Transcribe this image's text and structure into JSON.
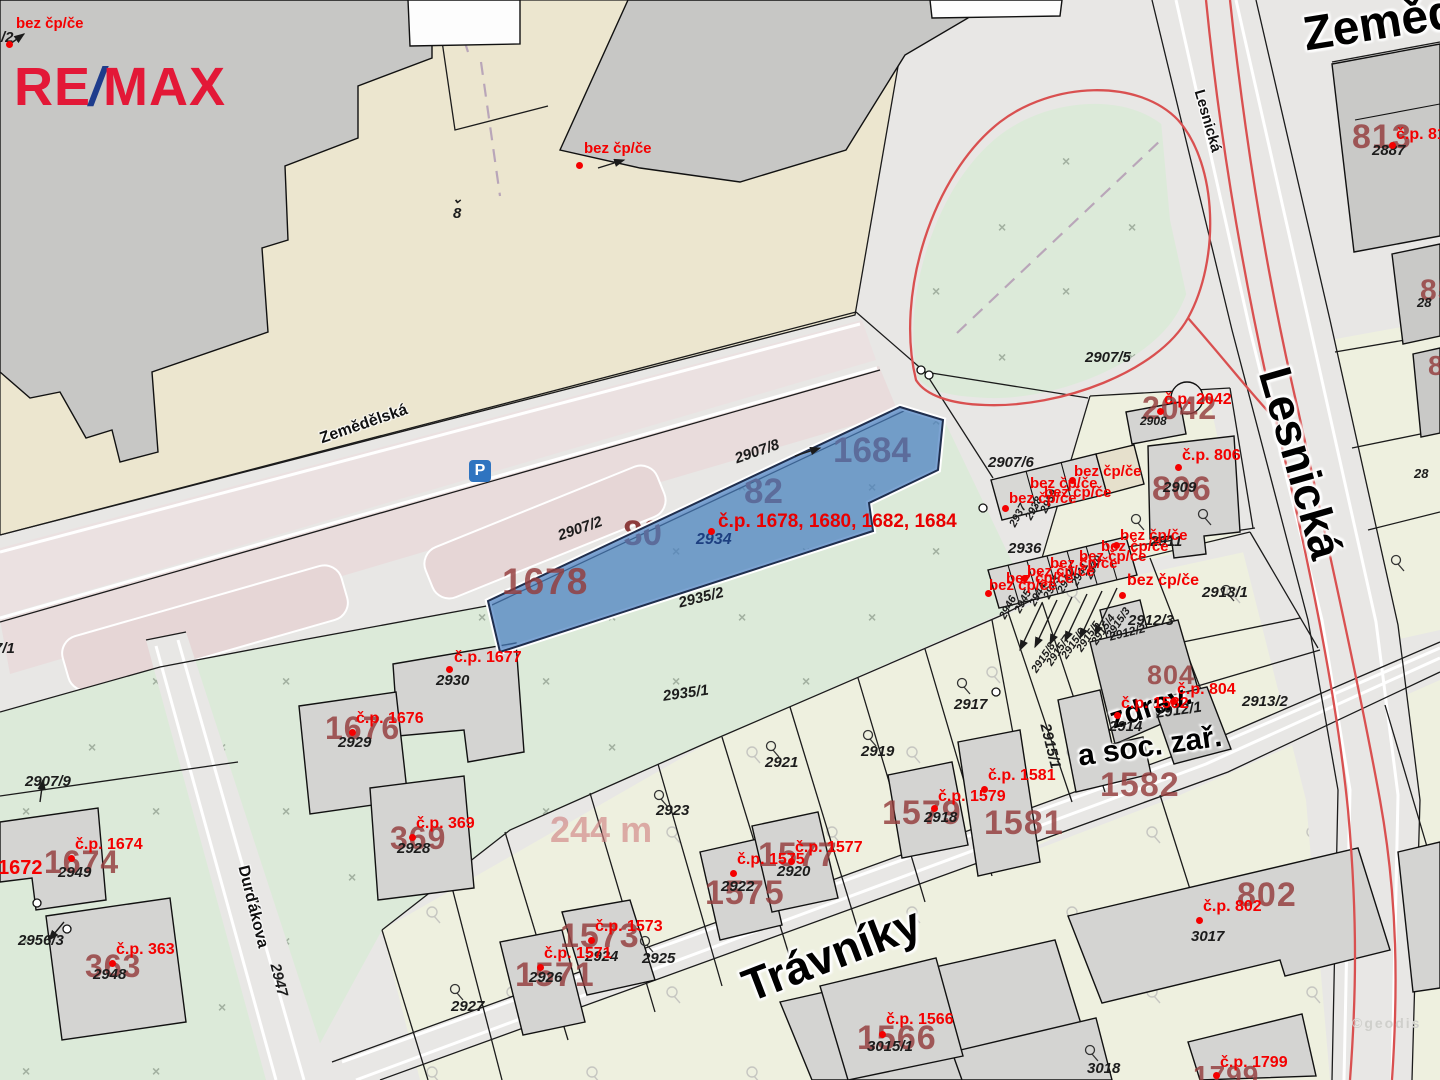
{
  "logo": {
    "re": "RE",
    "slash": "/",
    "max": "MAX",
    "red": "#e31837",
    "blue": "#1e3c8c"
  },
  "parking": {
    "letter": "P",
    "bg": "#2f74c0"
  },
  "watermark": "©geodis",
  "subject": {
    "highlight_color": "#4a7fc1",
    "label": "č.p. 1678, 1680, 1682, 1684",
    "parcel_number": "2934",
    "area_label": "244 m"
  },
  "under_blue": [
    {
      "text": "1684"
    },
    {
      "text": "82"
    },
    {
      "text": "80"
    }
  ],
  "labels": [
    {
      "t": "Zemědě",
      "x": 1300,
      "y": 12,
      "r": -9,
      "c": "xl",
      "s": 48,
      "n": "street-label-zemedelska-large"
    },
    {
      "t": "Lesnická",
      "x": 1206,
      "y": 88,
      "r": 74,
      "c": "sm",
      "s": 15,
      "n": "street-label-lesnicka-small"
    },
    {
      "t": "Lesnická",
      "x": 1296,
      "y": 362,
      "r": 74,
      "c": "xl",
      "n": "street-label-lesnicka-large"
    },
    {
      "t": "Zemědělská",
      "x": 318,
      "y": 432,
      "r": -19,
      "c": "sm",
      "n": "street-label-zemedelska-small"
    },
    {
      "t": "Trávníky",
      "x": 736,
      "y": 966,
      "r": -21,
      "c": "xl",
      "n": "street-label-travniky"
    },
    {
      "t": "Durďákova",
      "x": 250,
      "y": 864,
      "r": 76,
      "c": "sm",
      "n": "street-label-durdakova"
    },
    {
      "t": "zdrav.",
      "x": 1106,
      "y": 706,
      "r": -18,
      "c": "md",
      "n": "building-use-label"
    },
    {
      "t": "a soc. zař.",
      "x": 1076,
      "y": 742,
      "r": -8,
      "c": "md",
      "n": "building-use-label"
    },
    {
      "t": "1678",
      "x": 502,
      "y": 563,
      "c": "nb",
      "s": 37,
      "n": "parcel-number-large"
    },
    {
      "t": "813",
      "x": 1352,
      "y": 120,
      "c": "nb",
      "n": "parcel-number-large"
    },
    {
      "t": "2042",
      "x": 1142,
      "y": 392,
      "c": "nb",
      "s": 32,
      "n": "parcel-number-large"
    },
    {
      "t": "806",
      "x": 1152,
      "y": 472,
      "c": "nb",
      "n": "parcel-number-large"
    },
    {
      "t": "804",
      "x": 1147,
      "y": 662,
      "c": "nb",
      "s": 27,
      "n": "parcel-number-large"
    },
    {
      "t": "1582",
      "x": 1100,
      "y": 768,
      "c": "nb",
      "n": "parcel-number-large"
    },
    {
      "t": "1581",
      "x": 984,
      "y": 806,
      "c": "nb",
      "n": "parcel-number-large"
    },
    {
      "t": "1579",
      "x": 882,
      "y": 796,
      "c": "nb",
      "n": "parcel-number-large"
    },
    {
      "t": "1577",
      "x": 758,
      "y": 838,
      "c": "nb",
      "n": "parcel-number-large"
    },
    {
      "t": "1575",
      "x": 705,
      "y": 876,
      "c": "nb",
      "n": "parcel-number-large"
    },
    {
      "t": "1573",
      "x": 560,
      "y": 919,
      "c": "nb",
      "n": "parcel-number-large"
    },
    {
      "t": "1571",
      "x": 515,
      "y": 958,
      "c": "nb",
      "n": "parcel-number-large"
    },
    {
      "t": "1566",
      "x": 857,
      "y": 1021,
      "c": "nb",
      "n": "parcel-number-large"
    },
    {
      "t": "802",
      "x": 1237,
      "y": 878,
      "c": "nb",
      "n": "parcel-number-large"
    },
    {
      "t": "1799",
      "x": 1193,
      "y": 1062,
      "c": "nb",
      "s": 28,
      "n": "parcel-number-large"
    },
    {
      "t": "1674",
      "x": 44,
      "y": 846,
      "c": "nb",
      "s": 32,
      "n": "parcel-number-large"
    },
    {
      "t": "363",
      "x": 85,
      "y": 950,
      "c": "nb",
      "s": 32,
      "n": "parcel-number-large"
    },
    {
      "t": "369",
      "x": 390,
      "y": 822,
      "c": "nb",
      "s": 32,
      "n": "parcel-number-large"
    },
    {
      "t": "1676",
      "x": 325,
      "y": 712,
      "c": "nb",
      "s": 32,
      "n": "parcel-number-large"
    },
    {
      "t": "85",
      "x": 1420,
      "y": 276,
      "c": "nb",
      "s": 30,
      "n": "parcel-number-large"
    },
    {
      "t": "8",
      "x": 1428,
      "y": 352,
      "c": "nb",
      "s": 28,
      "n": "parcel-number-large"
    },
    {
      "t": "244 m",
      "x": 550,
      "y": 812,
      "c": "nf",
      "n": "area-measure-label"
    },
    {
      "t": "/2",
      "x": 1,
      "y": 30,
      "c": "bk",
      "n": "parcel-number"
    },
    {
      "t": "7/1",
      "x": -6,
      "y": 641,
      "c": "bk",
      "n": "parcel-number"
    },
    {
      "t": "⌄",
      "x": 452,
      "y": 192,
      "c": "bk",
      "s": 13,
      "n": "map-symbol"
    },
    {
      "t": "8",
      "x": 453,
      "y": 206,
      "c": "bk",
      "n": "parcel-number"
    },
    {
      "t": "2887",
      "x": 1372,
      "y": 143,
      "c": "bk",
      "n": "parcel-number"
    },
    {
      "t": "2908",
      "x": 1140,
      "y": 415,
      "c": "bk",
      "s": 12,
      "n": "parcel-number"
    },
    {
      "t": "2909",
      "x": 1163,
      "y": 480,
      "c": "bk",
      "n": "parcel-number"
    },
    {
      "t": "2907/5",
      "x": 1085,
      "y": 350,
      "c": "bk",
      "n": "parcel-number"
    },
    {
      "t": "2907/6",
      "x": 988,
      "y": 455,
      "c": "bk",
      "n": "parcel-number"
    },
    {
      "t": "2907/8",
      "x": 733,
      "y": 452,
      "r": -19,
      "c": "bk",
      "n": "parcel-number"
    },
    {
      "t": "2907/2",
      "x": 556,
      "y": 529,
      "r": -19,
      "c": "bk",
      "n": "parcel-number"
    },
    {
      "t": "2935/2",
      "x": 677,
      "y": 596,
      "r": -14,
      "c": "bk",
      "n": "parcel-number"
    },
    {
      "t": "2935/1",
      "x": 662,
      "y": 689,
      "r": -8,
      "c": "bk",
      "n": "parcel-number"
    },
    {
      "t": "2936",
      "x": 1008,
      "y": 541,
      "c": "bk",
      "n": "parcel-number"
    },
    {
      "t": "2937",
      "x": 1008,
      "y": 524,
      "r": -62,
      "c": "bk",
      "s": 11,
      "n": "parcel-number"
    },
    {
      "t": "2938",
      "x": 1024,
      "y": 517,
      "r": -62,
      "c": "bk",
      "s": 11,
      "n": "parcel-number"
    },
    {
      "t": "2939",
      "x": 1039,
      "y": 510,
      "r": -62,
      "c": "bk",
      "s": 11,
      "n": "parcel-number"
    },
    {
      "t": "2946",
      "x": 998,
      "y": 616,
      "r": -62,
      "c": "bk",
      "s": 11,
      "n": "parcel-number"
    },
    {
      "t": "2945",
      "x": 1013,
      "y": 610,
      "r": -62,
      "c": "bk",
      "s": 11,
      "n": "parcel-number"
    },
    {
      "t": "2944",
      "x": 1028,
      "y": 603,
      "r": -62,
      "c": "bk",
      "s": 11,
      "n": "parcel-number"
    },
    {
      "t": "2943",
      "x": 1042,
      "y": 596,
      "r": -62,
      "c": "bk",
      "s": 11,
      "n": "parcel-number"
    },
    {
      "t": "2942",
      "x": 1056,
      "y": 590,
      "r": -62,
      "c": "bk",
      "s": 11,
      "n": "parcel-number"
    },
    {
      "t": "2941",
      "x": 1070,
      "y": 583,
      "r": -62,
      "c": "bk",
      "s": 11,
      "n": "parcel-number"
    },
    {
      "t": "2940",
      "x": 1084,
      "y": 576,
      "r": -62,
      "c": "bk",
      "s": 11,
      "n": "parcel-number"
    },
    {
      "t": "2911",
      "x": 1150,
      "y": 534,
      "c": "bk",
      "n": "parcel-number"
    },
    {
      "t": "2912/2",
      "x": 1108,
      "y": 631,
      "r": -14,
      "c": "bk",
      "s": 12,
      "n": "parcel-number"
    },
    {
      "t": "2912/3",
      "x": 1128,
      "y": 613,
      "c": "bk",
      "n": "parcel-number"
    },
    {
      "t": "2912/1",
      "x": 1155,
      "y": 706,
      "r": -8,
      "c": "bk",
      "n": "parcel-number"
    },
    {
      "t": "2913/1",
      "x": 1202,
      "y": 585,
      "c": "bk",
      "n": "parcel-number"
    },
    {
      "t": "2913/2",
      "x": 1242,
      "y": 694,
      "c": "bk",
      "n": "parcel-number"
    },
    {
      "t": "2914",
      "x": 1109,
      "y": 719,
      "c": "bk",
      "n": "parcel-number"
    },
    {
      "t": "2915/1",
      "x": 1052,
      "y": 722,
      "r": 76,
      "c": "bk",
      "n": "parcel-number"
    },
    {
      "t": "2915/8",
      "x": 1030,
      "y": 669,
      "r": -56,
      "c": "bk",
      "s": 11,
      "n": "parcel-number"
    },
    {
      "t": "2915/7",
      "x": 1045,
      "y": 662,
      "r": -56,
      "c": "bk",
      "s": 11,
      "n": "parcel-number"
    },
    {
      "t": "2915/6",
      "x": 1060,
      "y": 655,
      "r": -56,
      "c": "bk",
      "s": 11,
      "n": "parcel-number"
    },
    {
      "t": "2915/5",
      "x": 1075,
      "y": 648,
      "r": -56,
      "c": "bk",
      "s": 11,
      "n": "parcel-number"
    },
    {
      "t": "2915/4",
      "x": 1090,
      "y": 641,
      "r": -56,
      "c": "bk",
      "s": 11,
      "n": "parcel-number"
    },
    {
      "t": "2915/3",
      "x": 1105,
      "y": 634,
      "r": -56,
      "c": "bk",
      "s": 11,
      "n": "parcel-number"
    },
    {
      "t": "2917",
      "x": 954,
      "y": 697,
      "c": "bk",
      "n": "parcel-number"
    },
    {
      "t": "2919",
      "x": 861,
      "y": 744,
      "c": "bk",
      "n": "parcel-number"
    },
    {
      "t": "2921",
      "x": 765,
      "y": 755,
      "c": "bk",
      "n": "parcel-number"
    },
    {
      "t": "2923",
      "x": 656,
      "y": 803,
      "c": "bk",
      "n": "parcel-number"
    },
    {
      "t": "2925",
      "x": 642,
      "y": 951,
      "c": "bk",
      "n": "parcel-number"
    },
    {
      "t": "2927",
      "x": 451,
      "y": 999,
      "c": "bk",
      "n": "parcel-number"
    },
    {
      "t": "2926",
      "x": 529,
      "y": 970,
      "c": "bk",
      "n": "parcel-number"
    },
    {
      "t": "2924",
      "x": 585,
      "y": 949,
      "c": "bk",
      "n": "parcel-number"
    },
    {
      "t": "2922",
      "x": 721,
      "y": 879,
      "c": "bk",
      "n": "parcel-number"
    },
    {
      "t": "2920",
      "x": 777,
      "y": 864,
      "c": "bk",
      "n": "parcel-number"
    },
    {
      "t": "2918",
      "x": 924,
      "y": 810,
      "c": "bk",
      "n": "parcel-number"
    },
    {
      "t": "2928",
      "x": 397,
      "y": 841,
      "c": "bk",
      "n": "parcel-number"
    },
    {
      "t": "2929",
      "x": 338,
      "y": 735,
      "c": "bk",
      "n": "parcel-number"
    },
    {
      "t": "2930",
      "x": 436,
      "y": 673,
      "c": "bk",
      "n": "parcel-number"
    },
    {
      "t": "2949",
      "x": 58,
      "y": 865,
      "c": "bk",
      "n": "parcel-number"
    },
    {
      "t": "2948",
      "x": 93,
      "y": 967,
      "c": "bk",
      "n": "parcel-number"
    },
    {
      "t": "2956/3",
      "x": 18,
      "y": 933,
      "c": "bk",
      "n": "parcel-number"
    },
    {
      "t": "2907/9",
      "x": 25,
      "y": 774,
      "c": "bk",
      "n": "parcel-number"
    },
    {
      "t": "3017",
      "x": 1191,
      "y": 929,
      "c": "bk",
      "n": "parcel-number"
    },
    {
      "t": "3018",
      "x": 1087,
      "y": 1061,
      "c": "bk",
      "n": "parcel-number"
    },
    {
      "t": "3015/1",
      "x": 867,
      "y": 1039,
      "c": "bk",
      "n": "parcel-number"
    },
    {
      "t": "2947",
      "x": 282,
      "y": 962,
      "r": 76,
      "c": "bk",
      "n": "parcel-number"
    },
    {
      "t": "28",
      "x": 1417,
      "y": 296,
      "c": "bk",
      "s": 13,
      "n": "parcel-number"
    },
    {
      "t": "28",
      "x": 1414,
      "y": 467,
      "c": "bk",
      "s": 13,
      "n": "parcel-number"
    },
    {
      "t": "2934",
      "x": 696,
      "y": 532,
      "c": "bu",
      "n": "subject-parcel-number"
    },
    {
      "t": "č.p. 1678, 1680, 1682, 1684",
      "x": 718,
      "y": 512,
      "c": "cpl",
      "n": "subject-house-number-label"
    },
    {
      "t": "bez čp/če",
      "x": 16,
      "y": 16,
      "c": "bez",
      "n": "house-number-label"
    },
    {
      "t": "bez čp/če",
      "x": 584,
      "y": 141,
      "c": "bez",
      "n": "house-number-label"
    },
    {
      "t": "č.p. 2042",
      "x": 1164,
      "y": 392,
      "c": "cp",
      "n": "house-number-label"
    },
    {
      "t": "č.p. 806",
      "x": 1182,
      "y": 448,
      "c": "cp",
      "n": "house-number-label"
    },
    {
      "t": "č.p. 81",
      "x": 1396,
      "y": 127,
      "c": "cp",
      "n": "house-number-label"
    },
    {
      "t": "č.p. 1677",
      "x": 454,
      "y": 650,
      "c": "cp",
      "n": "house-number-label"
    },
    {
      "t": "č.p. 1676",
      "x": 356,
      "y": 711,
      "c": "cp",
      "n": "house-number-label"
    },
    {
      "t": "č.p. 369",
      "x": 416,
      "y": 816,
      "c": "cp",
      "n": "house-number-label"
    },
    {
      "t": "č.p. 363",
      "x": 116,
      "y": 942,
      "c": "cp",
      "n": "house-number-label"
    },
    {
      "t": "č.p. 1674",
      "x": 75,
      "y": 837,
      "c": "cp",
      "n": "house-number-label"
    },
    {
      "t": "1672",
      "x": -2,
      "y": 858,
      "c": "cp",
      "s": 20,
      "n": "house-number-label"
    },
    {
      "t": "č.p. 1582",
      "x": 1121,
      "y": 696,
      "c": "cp",
      "n": "house-number-label"
    },
    {
      "t": "č.p. 804",
      "x": 1177,
      "y": 682,
      "c": "cp",
      "n": "house-number-label"
    },
    {
      "t": "č.p. 1581",
      "x": 988,
      "y": 768,
      "c": "cp",
      "n": "house-number-label"
    },
    {
      "t": "č.p. 1579",
      "x": 938,
      "y": 789,
      "c": "cp",
      "n": "house-number-label"
    },
    {
      "t": "č.p. 1577",
      "x": 795,
      "y": 840,
      "c": "cp",
      "n": "house-number-label"
    },
    {
      "t": "č.p. 1575",
      "x": 737,
      "y": 852,
      "c": "cp",
      "n": "house-number-label"
    },
    {
      "t": "č.p. 1573",
      "x": 595,
      "y": 919,
      "c": "cp",
      "n": "house-number-label"
    },
    {
      "t": "č.p. 1571",
      "x": 544,
      "y": 946,
      "c": "cp",
      "n": "house-number-label"
    },
    {
      "t": "č.p. 1566",
      "x": 886,
      "y": 1012,
      "c": "cp",
      "n": "house-number-label"
    },
    {
      "t": "č.p. 802",
      "x": 1203,
      "y": 899,
      "c": "cp",
      "n": "house-number-label"
    },
    {
      "t": "č.p. 1799",
      "x": 1220,
      "y": 1055,
      "c": "cp",
      "n": "house-number-label"
    },
    {
      "t": "bez čp/če",
      "x": 1074,
      "y": 464,
      "c": "bez",
      "n": "house-number-label"
    },
    {
      "t": "bez čp/če",
      "x": 1030,
      "y": 476,
      "c": "bez",
      "n": "house-number-label"
    },
    {
      "t": "bez čp/če",
      "x": 1044,
      "y": 485,
      "c": "bez",
      "n": "house-number-label"
    },
    {
      "t": "bez čp/če",
      "x": 1009,
      "y": 491,
      "c": "bez",
      "n": "house-number-label"
    },
    {
      "t": "bez čp/če",
      "x": 1120,
      "y": 528,
      "c": "bez",
      "n": "house-number-label"
    },
    {
      "t": "bez čp/če",
      "x": 1101,
      "y": 539,
      "c": "bez",
      "n": "house-number-label"
    },
    {
      "t": "bez čp/če",
      "x": 1079,
      "y": 549,
      "c": "bez",
      "n": "house-number-label"
    },
    {
      "t": "bez čp/če",
      "x": 1050,
      "y": 556,
      "c": "bez",
      "n": "house-number-label"
    },
    {
      "t": "bez čp/če",
      "x": 1027,
      "y": 564,
      "c": "bez",
      "n": "house-number-label"
    },
    {
      "t": "bez čp/če",
      "x": 1006,
      "y": 571,
      "c": "bez",
      "n": "house-number-label"
    },
    {
      "t": "bez čp/če",
      "x": 989,
      "y": 578,
      "c": "bez",
      "n": "house-number-label"
    },
    {
      "t": "bez čp/če",
      "x": 1127,
      "y": 573,
      "c": "bez",
      "s": 16,
      "n": "house-number-label"
    }
  ],
  "dots": [
    {
      "x": 6,
      "y": 41
    },
    {
      "x": 576,
      "y": 162
    },
    {
      "x": 1157,
      "y": 408
    },
    {
      "x": 1175,
      "y": 464
    },
    {
      "x": 1389,
      "y": 142
    },
    {
      "x": 708,
      "y": 528
    },
    {
      "x": 446,
      "y": 666
    },
    {
      "x": 349,
      "y": 729
    },
    {
      "x": 409,
      "y": 834
    },
    {
      "x": 109,
      "y": 960
    },
    {
      "x": 68,
      "y": 855
    },
    {
      "x": 1114,
      "y": 712
    },
    {
      "x": 1170,
      "y": 698
    },
    {
      "x": 981,
      "y": 786
    },
    {
      "x": 931,
      "y": 805
    },
    {
      "x": 788,
      "y": 858
    },
    {
      "x": 730,
      "y": 870
    },
    {
      "x": 588,
      "y": 937
    },
    {
      "x": 537,
      "y": 964
    },
    {
      "x": 879,
      "y": 1031
    },
    {
      "x": 1196,
      "y": 917
    },
    {
      "x": 1213,
      "y": 1072
    },
    {
      "x": 1002,
      "y": 505
    },
    {
      "x": 985,
      "y": 590
    },
    {
      "x": 1069,
      "y": 477
    },
    {
      "x": 1113,
      "y": 542
    },
    {
      "x": 1021,
      "y": 575
    },
    {
      "x": 1119,
      "y": 592
    }
  ]
}
